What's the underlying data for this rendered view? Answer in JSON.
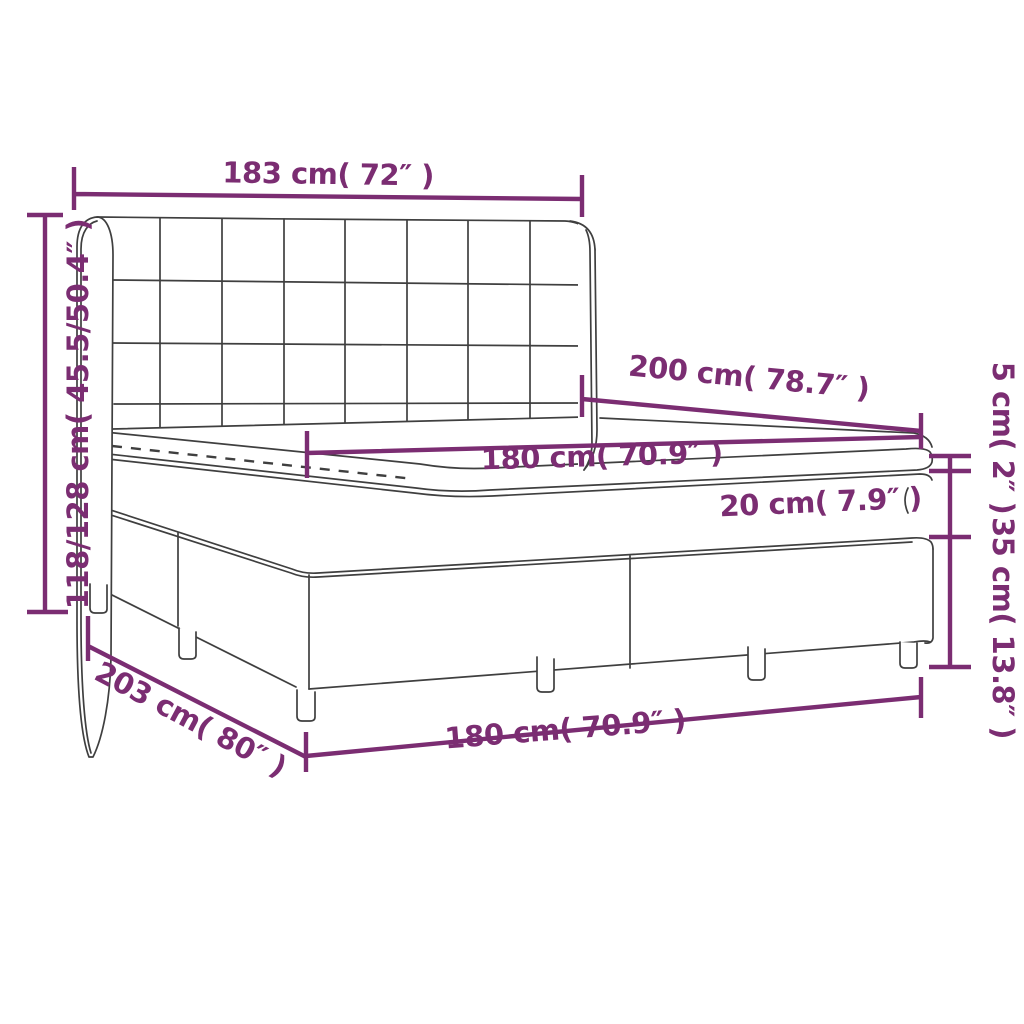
{
  "diagram": {
    "title": "Box spring bed with headboard, mattress and topper — dimension diagram",
    "accent_color": "#7b2d72",
    "line_color": "#3f3f3f",
    "background_color": "#ffffff",
    "labels": {
      "headboard_width": "183 cm( 72″ )",
      "bed_height": "118/128 cm( 45.5/50.4″ )",
      "mattress_length": "200 cm( 78.7″ )",
      "mattress_top_width": "180 cm( 70.9″ )",
      "mattress_height": "20 cm( 7.9″ )",
      "topper_height": "5 cm( 2″ )",
      "base_height": "35 cm( 13.8″ )",
      "bed_length": "203 cm( 80″ )",
      "bed_width": "180 cm( 70.9″ )"
    }
  }
}
